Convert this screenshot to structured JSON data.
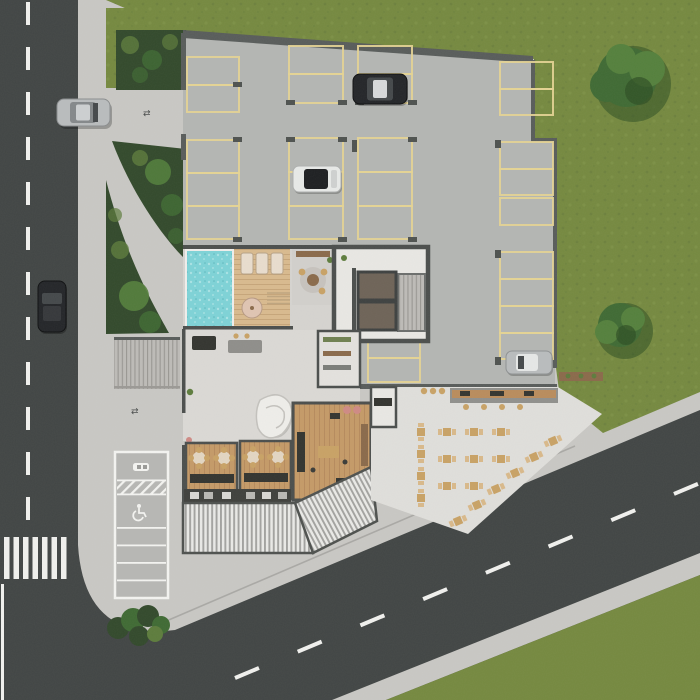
{
  "scene": {
    "title": "Top-down 3D architectural site plan — residential building ground floor",
    "areas": [
      "street-left",
      "street-diagonal",
      "crosswalk",
      "lawn-right",
      "parking-garage",
      "swimming-pool",
      "pool-deck",
      "lounge-room",
      "elevator-core",
      "lobby",
      "restaurant-dining-rooms",
      "restaurant-kitchen",
      "louvered-canopy",
      "outdoor-terrace",
      "surface-parking-strip",
      "garden-beds",
      "entry-driveway"
    ],
    "counts": {
      "street_cars": 2,
      "garage_cars": 3,
      "trees_on_lawn": 2,
      "sun_loungers": 3,
      "indoor_dining_tables": 4,
      "terrace_tables": 18,
      "crosswalk_stripes": 7,
      "surface_parking_bays": 6
    },
    "notes": "No text labels are visible in the render; markings are road paint, yellow parking stalls, an accessible-parking bay and a car-wash style bay icon."
  },
  "icons": {
    "direction_arrows_glyph": "⇄",
    "accessible_parking": "wheelchair-icon",
    "car_bay_marking": "car-icon"
  },
  "colors": {
    "asphalt": "#414544",
    "roadline": "#f1f1ee",
    "sidewalk": "#c9c8c4",
    "plaza": "#cfcecb",
    "terrace": "#e0dfdb",
    "grass": "#75893f",
    "grassdark": "#6a7e3c",
    "hedge": "#32492b",
    "shrub": "#5d7c3c",
    "tree": "#3f6a33",
    "treelight": "#54803c",
    "treedark": "#2d4f22",
    "garagefloor": "#b4b6b3",
    "garagewall": "#585c5a",
    "stallyellow": "#e5d494",
    "pool": "#7ed3d7",
    "pooldot": "#aae3e5",
    "deck": "#d9ba8e",
    "deckline": "#c2a074",
    "interior": "#dbd9d5",
    "interiorwall": "#4b4e4c",
    "wood": "#c59a67",
    "woodline": "#b2865a",
    "counter": "#33342f",
    "tan": "#c9a265",
    "brown": "#8a6a4a",
    "whiteobj": "#efeeea",
    "shaft": "#6e6357",
    "canopylight": "#eaeae7",
    "canopydark": "#a2a29f",
    "parkstrip": "#b7b7b4",
    "white": "#f4f4f1",
    "carblack": "#232528",
    "carsilver": "#b9bcbd",
    "carwhite": "#e8eae8",
    "glass": "#44484a"
  }
}
